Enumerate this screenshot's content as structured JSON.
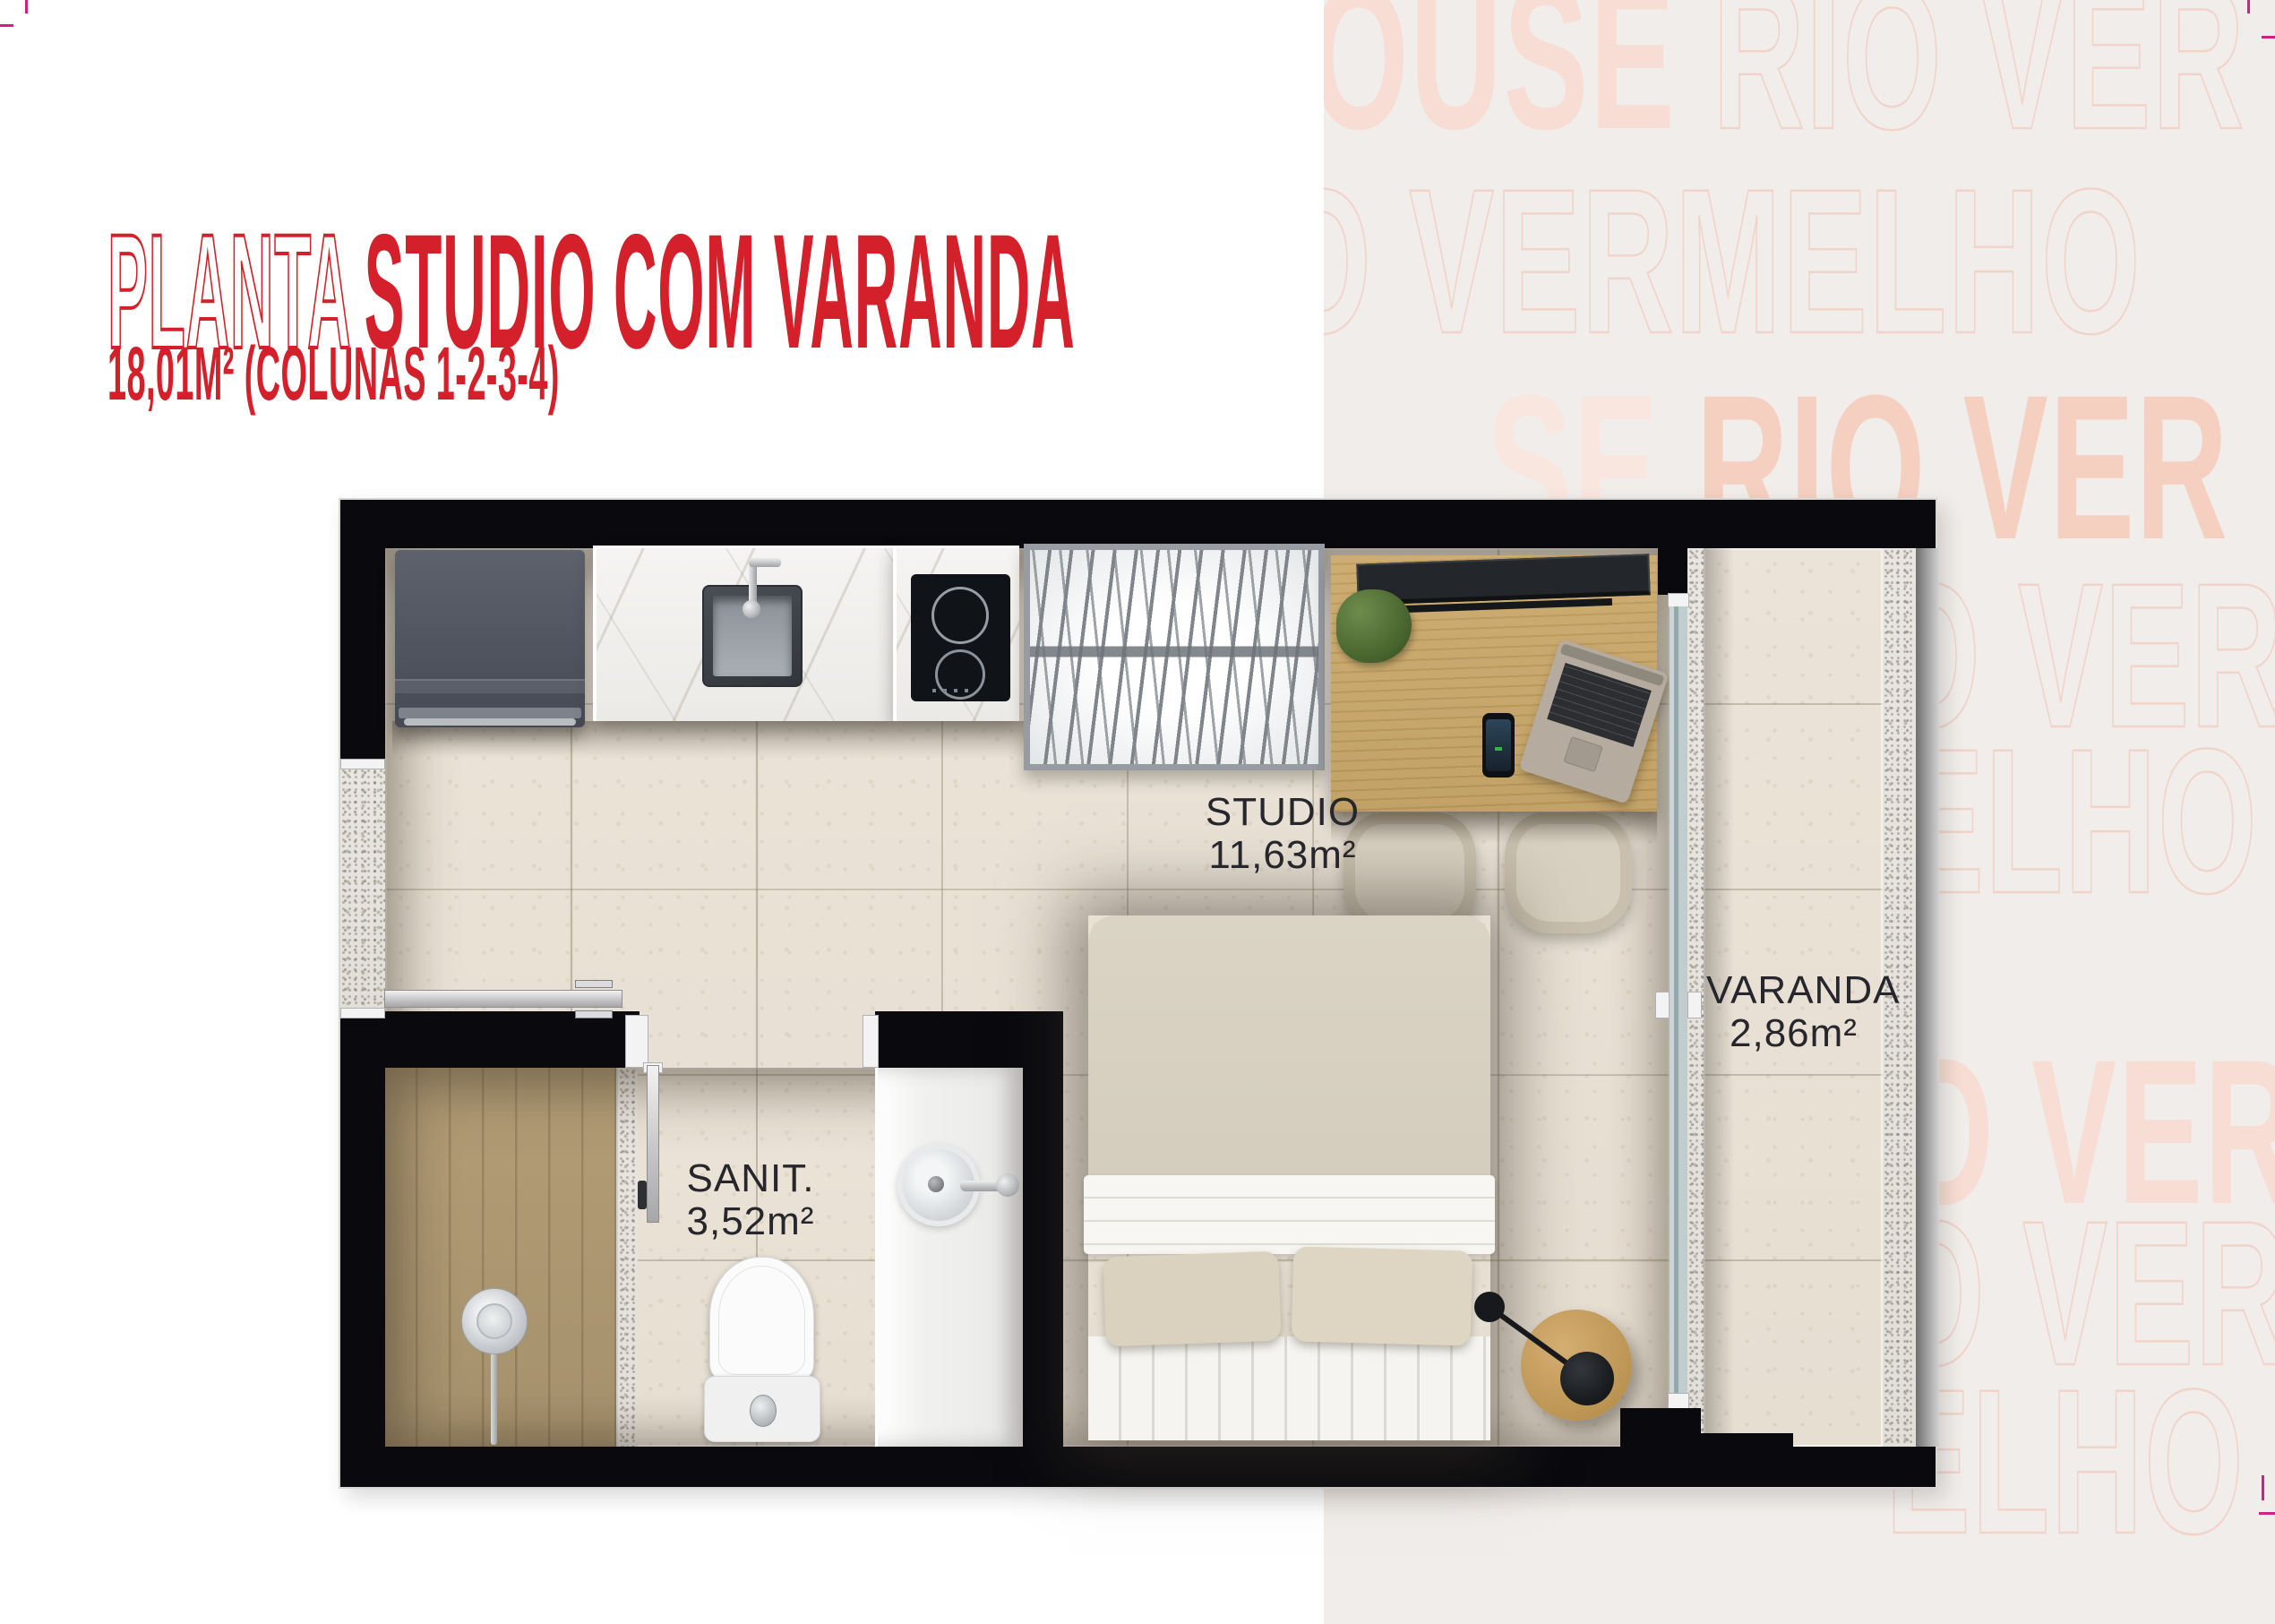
{
  "page": {
    "background_left": "#ffffff",
    "background_right_panel": "#f1edea",
    "accent_red": "#d3202a",
    "crop_mark_color": "#d31f80"
  },
  "header": {
    "title_outline": "PLANTA",
    "title_solid": "STUDIO COM VARANDA",
    "subtitle": "18,01M² (COLUNAS 1-2-3-4)"
  },
  "watermark": {
    "solid_color": "#f7ddd3",
    "outline_color": "#f1d3c9",
    "rows": [
      {
        "segments": [
          {
            "text": "OUSE ",
            "style": "solid"
          },
          {
            "text": "RIO VER",
            "style": "outline"
          }
        ]
      },
      {
        "segments": [
          {
            "text": "O VERMELHO",
            "style": "outline"
          }
        ]
      },
      {
        "segments": [
          {
            "text": "SE ",
            "style": "solid-light"
          },
          {
            "text": "RIO VER",
            "style": "solid-strong"
          }
        ]
      },
      {
        "segments": [
          {
            "text": "O VER",
            "style": "outline"
          }
        ]
      },
      {
        "segments": [
          {
            "text": "ELHO",
            "style": "outline"
          }
        ]
      },
      {
        "segments": [
          {
            "text": "O VER",
            "style": "solid"
          }
        ]
      },
      {
        "segments": [
          {
            "text": "O VER",
            "style": "outline"
          }
        ]
      },
      {
        "segments": [
          {
            "text": "ELHO",
            "style": "outline"
          }
        ]
      }
    ]
  },
  "floor_plan": {
    "rooms": [
      {
        "name": "STUDIO",
        "area": "11,63m²"
      },
      {
        "name": "SANIT.",
        "area": "3,52m²"
      },
      {
        "name": "VARANDA",
        "area": "2,86m²"
      }
    ],
    "fixtures": [
      "washer",
      "kitchen-sink",
      "cooktop",
      "drying-rack",
      "desk",
      "tv",
      "plant",
      "laptop",
      "phone",
      "chair",
      "chair",
      "bed",
      "pillows",
      "side-table",
      "lamp",
      "entry-door",
      "bathroom-door",
      "shower",
      "shower-head",
      "toilet",
      "bathroom-sink",
      "sliding-glass-door",
      "balcony"
    ]
  }
}
